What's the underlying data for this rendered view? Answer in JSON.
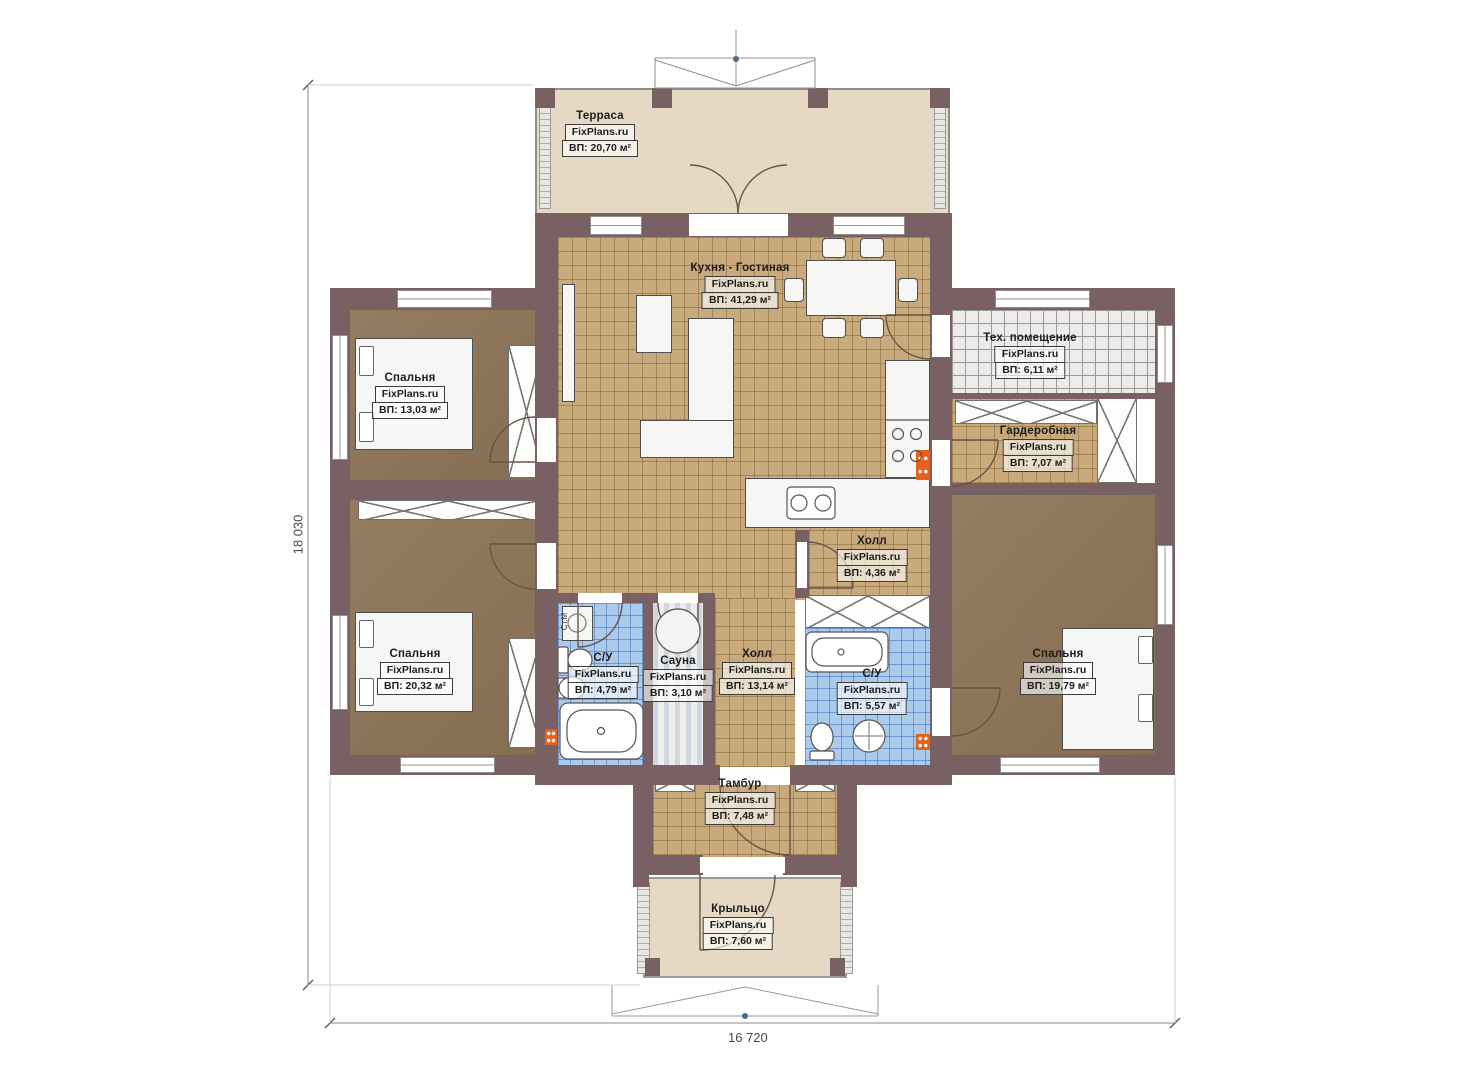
{
  "plan_title": "Одноэтажный дом — план этажа",
  "brand": "FixPlans.ru",
  "dimensions": {
    "height_label": "18 030",
    "width_label": "16 720"
  },
  "rooms": [
    {
      "key": "terrace",
      "name": "Терраса",
      "brand": "FixPlans.ru",
      "area": "ВП: 20,70 м²"
    },
    {
      "key": "kitchen_living",
      "name": "Кухня - Гостиная",
      "brand": "FixPlans.ru",
      "area": "ВП: 41,29 м²"
    },
    {
      "key": "tech_room",
      "name": "Тех. помещение",
      "brand": "FixPlans.ru",
      "area": "ВП: 6,11 м²"
    },
    {
      "key": "wardrobe",
      "name": "Гардеробная",
      "brand": "FixPlans.ru",
      "area": "ВП: 7,07 м²"
    },
    {
      "key": "bedroom_top_left",
      "name": "Спальня",
      "brand": "FixPlans.ru",
      "area": "ВП: 13,03 м²"
    },
    {
      "key": "bedroom_bottom_left",
      "name": "Спальня",
      "brand": "FixPlans.ru",
      "area": "ВП: 20,32 м²"
    },
    {
      "key": "bathroom_left",
      "name": "С/У",
      "brand": "FixPlans.ru",
      "area": "ВП: 4,79 м²"
    },
    {
      "key": "sauna",
      "name": "Сауна",
      "brand": "FixPlans.ru",
      "area": "ВП: 3,10 м²"
    },
    {
      "key": "hall_main",
      "name": "Холл",
      "brand": "FixPlans.ru",
      "area": "ВП: 13,14 м²"
    },
    {
      "key": "hall_small",
      "name": "Холл",
      "brand": "FixPlans.ru",
      "area": "ВП: 4,36 м²"
    },
    {
      "key": "bathroom_right",
      "name": "С/У",
      "brand": "FixPlans.ru",
      "area": "ВП: 5,57 м²"
    },
    {
      "key": "bedroom_right",
      "name": "Спальня",
      "brand": "FixPlans.ru",
      "area": "ВП: 19,79 м²"
    },
    {
      "key": "tambur",
      "name": "Тамбур",
      "brand": "FixPlans.ru",
      "area": "ВП: 7,48 м²"
    },
    {
      "key": "porch",
      "name": "Крыльцо",
      "brand": "FixPlans.ru",
      "area": "ВП: 7,60 м²"
    }
  ],
  "annotations": {
    "washing_machine": "Ст.М"
  },
  "colors": {
    "wall": "#796163",
    "floor_tile_tan": "#c9aa7d",
    "floor_wood_brown": "#8d7557",
    "floor_tile_blue": "#abcbec",
    "floor_tile_grey": "#ececea",
    "terrace_beige": "#e5d9c4",
    "radiator_orange": "#e8611c"
  }
}
